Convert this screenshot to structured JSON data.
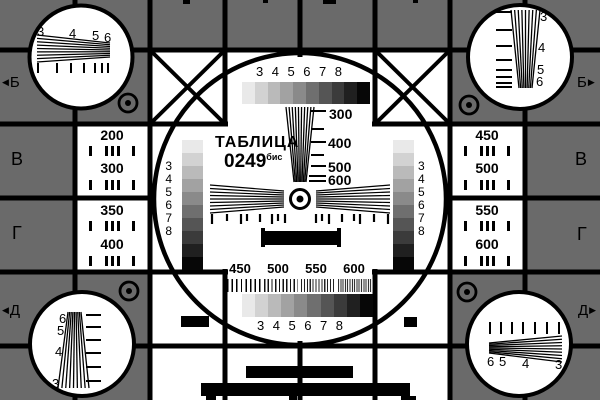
{
  "card": {
    "title_line1": "ТАБЛИЦА",
    "title_line2": "0249",
    "title_sup": "бис"
  },
  "colors": {
    "background": "#6a6a6a",
    "ink": "#000000",
    "paper": "#ffffff"
  },
  "grays": [
    "#e9e9e9",
    "#d2d2d2",
    "#bababa",
    "#a2a2a2",
    "#8a8a8a",
    "#6f6f6f",
    "#555555",
    "#3b3b3b",
    "#202020",
    "#070707"
  ],
  "margins": {
    "left": [
      {
        "arrow": "◀",
        "label": "Б"
      },
      {
        "label": "В"
      },
      {
        "label": "Г"
      },
      {
        "arrow": "◀",
        "label": "Д"
      }
    ],
    "right": [
      {
        "label": "Б",
        "arrow": "▶"
      },
      {
        "label": "В"
      },
      {
        "label": "Г"
      },
      {
        "label": "Д",
        "arrow": "▶"
      }
    ]
  },
  "side_panels": {
    "left": [
      "200",
      "300",
      "350",
      "400"
    ],
    "right": [
      "450",
      "500",
      "550",
      "600"
    ]
  },
  "corner_wedges": {
    "top_left": [
      "3",
      "4",
      "5",
      "6"
    ],
    "top_right": [
      "3",
      "4",
      "5",
      "6"
    ],
    "bottom_left": [
      "6",
      "5",
      "4",
      "3"
    ],
    "bottom_right": [
      "6",
      "5",
      "4",
      "3"
    ]
  },
  "center": {
    "grayscale_labels_top": [
      "3",
      "4",
      "5",
      "6",
      "7",
      "8"
    ],
    "grayscale_labels_bottom": [
      "3",
      "4",
      "5",
      "6",
      "7",
      "8"
    ],
    "strip_labels_left": [
      "3",
      "4",
      "5",
      "6",
      "7",
      "8"
    ],
    "strip_labels_right": [
      "3",
      "4",
      "5",
      "6",
      "7",
      "8"
    ],
    "freq_labels_vertical": [
      "300",
      "400",
      "500",
      "600"
    ],
    "freq_labels_bottom": [
      "450",
      "500",
      "550",
      "600"
    ]
  }
}
